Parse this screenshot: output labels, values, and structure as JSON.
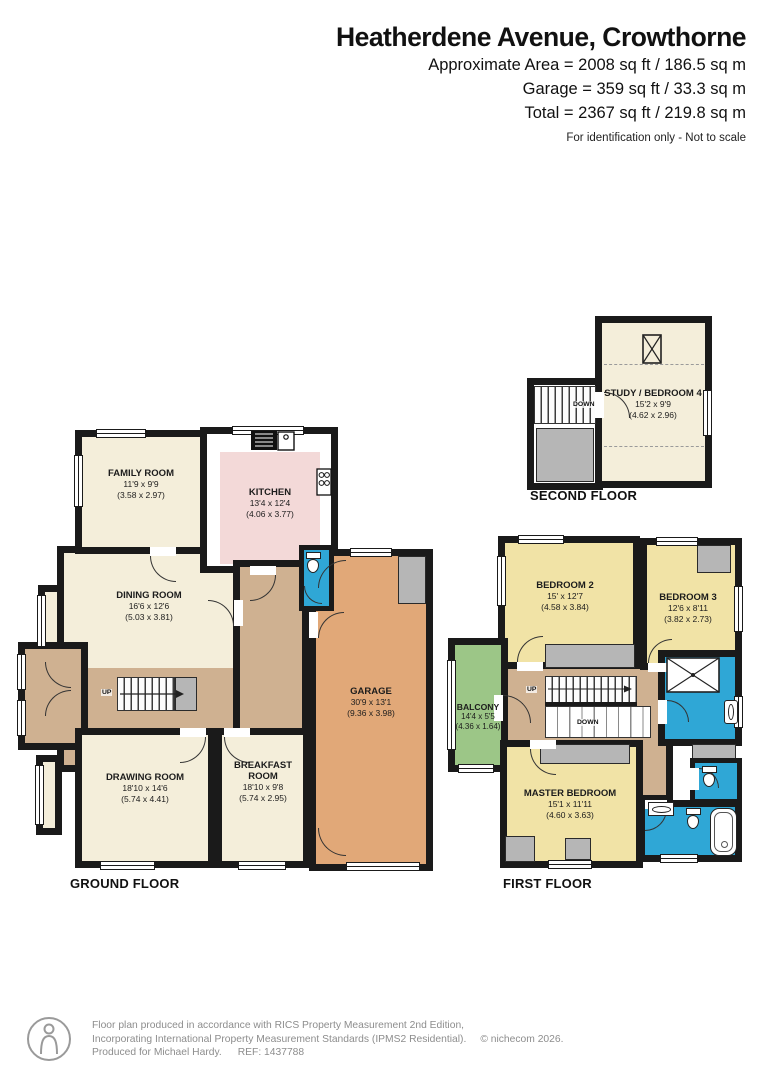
{
  "header": {
    "title": "Heatherdene Avenue, Crowthorne",
    "approx_area": "Approximate Area = 2008 sq ft / 186.5 sq m",
    "garage_area": "Garage = 359 sq ft / 33.3 sq m",
    "total_area": "Total = 2367 sq ft / 219.8 sq m",
    "disclaimer": "For identification only - Not to scale"
  },
  "floor_labels": {
    "second": "SECOND FLOOR",
    "ground": "GROUND FLOOR",
    "first": "FIRST FLOOR"
  },
  "stairs": {
    "up": "UP",
    "down": "DOWN"
  },
  "rooms": {
    "study": {
      "name": "STUDY / BEDROOM 4",
      "imperial": "15'2 x 9'9",
      "metric": "(4.62 x 2.96)"
    },
    "family": {
      "name": "FAMILY ROOM",
      "imperial": "11'9 x 9'9",
      "metric": "(3.58 x 2.97)"
    },
    "kitchen": {
      "name": "KITCHEN",
      "imperial": "13'4 x 12'4",
      "metric": "(4.06 x 3.77)"
    },
    "dining": {
      "name": "DINING ROOM",
      "imperial": "16'6 x 12'6",
      "metric": "(5.03 x 3.81)"
    },
    "drawing": {
      "name": "DRAWING ROOM",
      "imperial": "18'10 x 14'6",
      "metric": "(5.74 x 4.41)"
    },
    "breakfast": {
      "name": "BREAKFAST ROOM",
      "imperial": "18'10 x 9'8",
      "metric": "(5.74 x 2.95)"
    },
    "garage": {
      "name": "GARAGE",
      "imperial": "30'9 x 13'1",
      "metric": "(9.36 x 3.98)"
    },
    "bedroom2": {
      "name": "BEDROOM 2",
      "imperial": "15' x 12'7",
      "metric": "(4.58 x 3.84)"
    },
    "bedroom3": {
      "name": "BEDROOM 3",
      "imperial": "12'6 x 8'11",
      "metric": "(3.82 x 2.73)"
    },
    "balcony": {
      "name": "BALCONY",
      "imperial": "14'4 x 5'5",
      "metric": "(4.36 x 1.64)"
    },
    "master": {
      "name": "MASTER BEDROOM",
      "imperial": "15'1 x 11'11",
      "metric": "(4.60 x 3.63)"
    }
  },
  "footer": {
    "line1": "Floor plan produced in accordance with RICS Property Measurement 2nd Edition,",
    "line2": "Incorporating International Property Measurement Standards (IPMS2 Residential).",
    "copyright": "© nichecom 2026.",
    "produced_for": "Produced for Michael Hardy.",
    "ref": "REF: 1437788"
  },
  "colors": {
    "wall": "#1a1a1a",
    "cream_room": "#f4eeda",
    "yellow_room": "#f1e3a6",
    "pink_room": "#f3d9d8",
    "tan_hall": "#cfb191",
    "garage_orange": "#e1a878",
    "balcony_green": "#9cc687",
    "bathroom_blue": "#2fa7d6",
    "gray_fitting": "#b6b6b6"
  }
}
